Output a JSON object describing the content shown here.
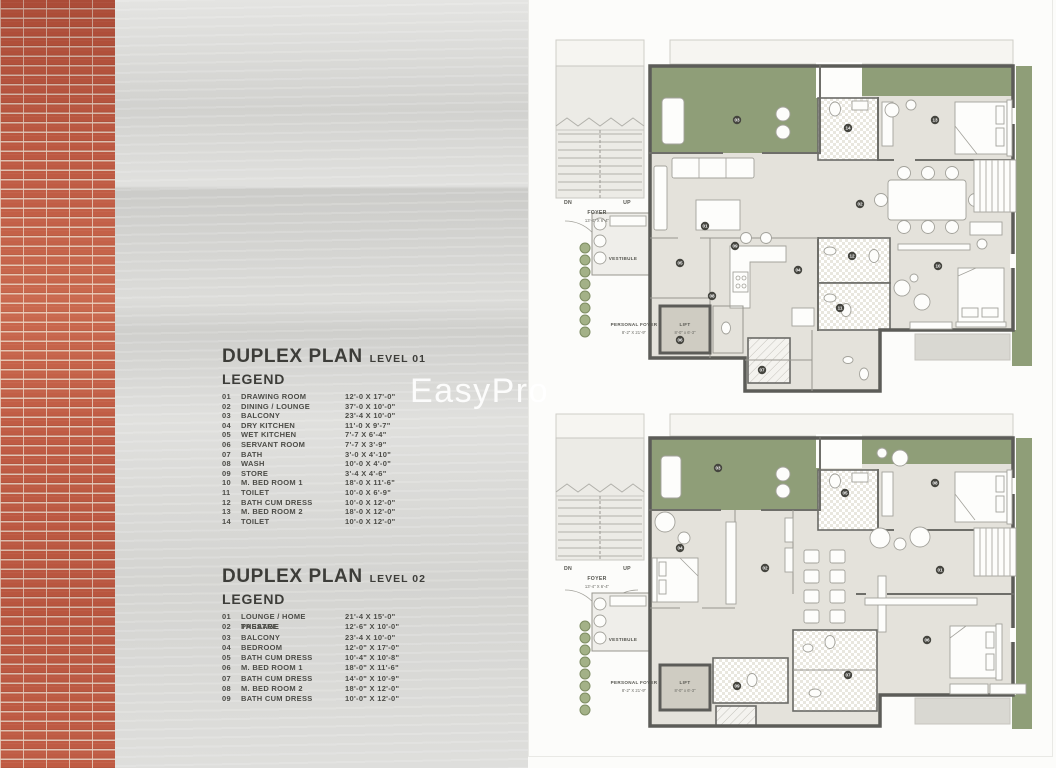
{
  "watermark": "EasyPro",
  "sections": [
    {
      "title": "DUPLEX PLAN",
      "level": "LEVEL 01",
      "legend_heading": "LEGEND",
      "items": [
        {
          "num": "01",
          "name": "DRAWING ROOM",
          "dim": "12'-0 X 17'-0\""
        },
        {
          "num": "02",
          "name": "DINING / LOUNGE",
          "dim": "37'-0 X 10'-0\""
        },
        {
          "num": "03",
          "name": "BALCONY",
          "dim": "23'-4 X 10'-0\""
        },
        {
          "num": "04",
          "name": "DRY KITCHEN",
          "dim": "11'-0 X 9'-7\""
        },
        {
          "num": "05",
          "name": "WET KITCHEN",
          "dim": "7'-7 X 6'-4\""
        },
        {
          "num": "06",
          "name": "SERVANT ROOM",
          "dim": "7'-7 X 3'-9\""
        },
        {
          "num": "07",
          "name": "BATH",
          "dim": "3'-0 X 4'-10\""
        },
        {
          "num": "08",
          "name": "WASH",
          "dim": "10'-0 X 4'-0\""
        },
        {
          "num": "09",
          "name": "STORE",
          "dim": "3'-4 X 4'-6\""
        },
        {
          "num": "10",
          "name": "M. BED ROOM 1",
          "dim": "18'-0 X 11'-6\""
        },
        {
          "num": "11",
          "name": "TOILET",
          "dim": "10'-0 X 6'-9\""
        },
        {
          "num": "12",
          "name": "BATH CUM DRESS",
          "dim": "10'-0 X 12'-0\""
        },
        {
          "num": "13",
          "name": "M. BED ROOM 2",
          "dim": "18'-0 X 12'-0\""
        },
        {
          "num": "14",
          "name": "TOILET",
          "dim": "10'-0 X 12'-0\""
        }
      ]
    },
    {
      "title": "DUPLEX PLAN",
      "level": "LEVEL 02",
      "legend_heading": "LEGEND",
      "items": [
        {
          "num": "01",
          "name": "LOUNGE / HOME THEATRE",
          "dim": "21'-4 X 15'-0\""
        },
        {
          "num": "02",
          "name": "PASSAGE",
          "dim": "12'-6\" X 10'-0\""
        },
        {
          "num": "03",
          "name": "BALCONY",
          "dim": "23'-4 X 10'-0\""
        },
        {
          "num": "04",
          "name": "BEDROOM",
          "dim": "12'-0\" X 17'-0\""
        },
        {
          "num": "05",
          "name": "BATH CUM DRESS",
          "dim": "10'-4\" X 10'-8\""
        },
        {
          "num": "06",
          "name": "M. BED ROOM 1",
          "dim": "18'-0\" X 11'-6\""
        },
        {
          "num": "07",
          "name": "BATH CUM DRESS",
          "dim": "14'-0\" X 10'-9\""
        },
        {
          "num": "08",
          "name": "M. BED ROOM 2",
          "dim": "18'-0\" X 12'-0\""
        },
        {
          "num": "09",
          "name": "BATH CUM DRESS",
          "dim": "10'-0\" X 12'-0\""
        }
      ]
    }
  ],
  "plans": [
    {
      "labels": {
        "dn": "DN",
        "up": "UP",
        "foyer": "FOYER",
        "foyer_dim": "13'-4\" X 6'-4\"",
        "vestibule": "VESTIBULE",
        "personal_foyer": "PERSONAL FOYER",
        "personal_foyer_dim": "8'-2\" X 21'-9\"",
        "lift": "LIFT",
        "lift_dim": "8'-0\" x 6'-3\""
      },
      "markers": [
        {
          "n": "01",
          "x": 175,
          "y": 218
        },
        {
          "n": "02",
          "x": 330,
          "y": 196
        },
        {
          "n": "03",
          "x": 207,
          "y": 112
        },
        {
          "n": "04",
          "x": 268,
          "y": 262
        },
        {
          "n": "05",
          "x": 150,
          "y": 255
        },
        {
          "n": "06",
          "x": 150,
          "y": 332
        },
        {
          "n": "07",
          "x": 232,
          "y": 362
        },
        {
          "n": "08",
          "x": 182,
          "y": 288
        },
        {
          "n": "09",
          "x": 205,
          "y": 238
        },
        {
          "n": "10",
          "x": 408,
          "y": 258
        },
        {
          "n": "11",
          "x": 310,
          "y": 300
        },
        {
          "n": "12",
          "x": 322,
          "y": 248
        },
        {
          "n": "13",
          "x": 405,
          "y": 112
        },
        {
          "n": "14",
          "x": 318,
          "y": 120
        }
      ]
    },
    {
      "labels": {
        "dn": "DN",
        "up": "UP",
        "foyer": "FOYER",
        "foyer_dim": "13'-4\" X 6'-4\"",
        "vestibule": "VESTIBULE",
        "personal_foyer": "PERSONAL FOYER",
        "personal_foyer_dim": "8'-2\" X 21'-9\"",
        "lift": "LIFT",
        "lift_dim": "8'-0\" x 6'-3\""
      },
      "markers": [
        {
          "n": "01",
          "x": 410,
          "y": 172
        },
        {
          "n": "02",
          "x": 235,
          "y": 170
        },
        {
          "n": "03",
          "x": 188,
          "y": 70
        },
        {
          "n": "04",
          "x": 150,
          "y": 150
        },
        {
          "n": "05",
          "x": 315,
          "y": 95
        },
        {
          "n": "06",
          "x": 397,
          "y": 242
        },
        {
          "n": "07",
          "x": 318,
          "y": 277
        },
        {
          "n": "08",
          "x": 405,
          "y": 85
        },
        {
          "n": "09",
          "x": 207,
          "y": 288
        }
      ]
    }
  ]
}
